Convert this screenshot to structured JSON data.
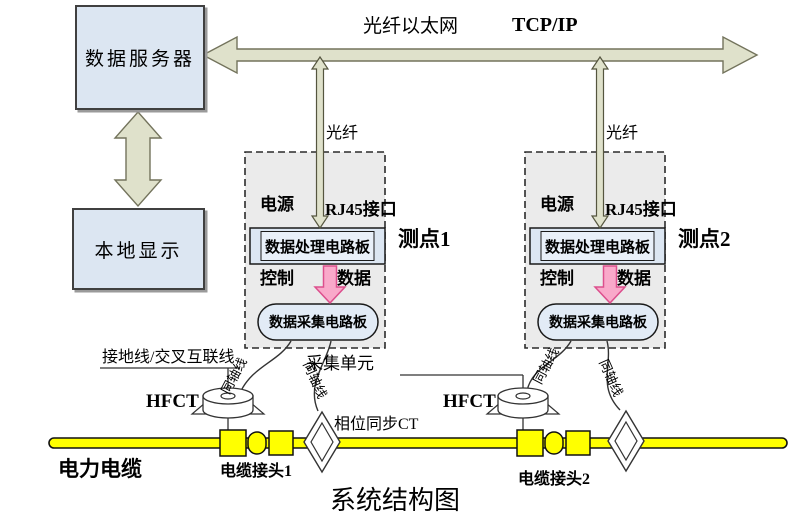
{
  "title": "系统结构图",
  "colors": {
    "node_fill": "#dce6f2",
    "panel_fill": "#ebebeb",
    "bus_arrow_fill": "#dfe1cb",
    "bus_arrow_stroke": "#73735c",
    "data_arrow_fill": "#f9a9ca",
    "data_arrow_stroke": "#dc4f8d",
    "cable_fill": "#ffff00",
    "board_inner_fill": "#e9f0f9"
  },
  "nodes": {
    "server": "数据服务器",
    "display": "本地显示"
  },
  "network": {
    "ethernet": "光纤以太网",
    "protocol": "TCP/IP",
    "fiber": "光纤"
  },
  "units": [
    {
      "name": "测点1",
      "power": "电源",
      "rj45": "RJ45接口",
      "processing_board": "数据处理电路板",
      "control": "控制",
      "data": "数据",
      "acquisition_board": "数据采集电路板",
      "coax_left": "同轴线",
      "coax_right": "同轴线",
      "hfct": "HFCT",
      "joint": "电缆接头1"
    },
    {
      "name": "测点2",
      "power": "电源",
      "rj45": "RJ45接口",
      "processing_board": "数据处理电路板",
      "control": "控制",
      "data": "数据",
      "acquisition_board": "数据采集电路板",
      "coax_left": "同轴线",
      "coax_right": "同轴线",
      "hfct": "HFCT",
      "joint": "电缆接头2"
    }
  ],
  "labels": {
    "ground_line": "接地线/交叉互联线",
    "acquisition_unit": "采集单元",
    "phase_ct": "相位同步CT",
    "power_cable": "电力电缆"
  }
}
